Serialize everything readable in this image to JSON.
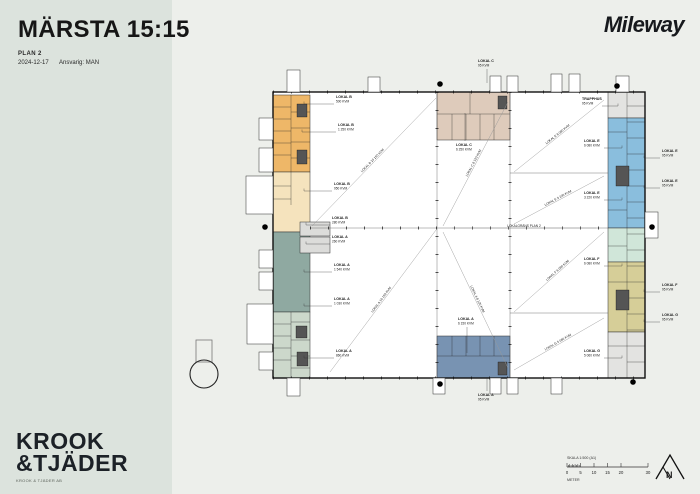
{
  "header": {
    "title": "MÄRSTA 15:15",
    "subtitle": "PLAN 2",
    "date": "2024-12-17",
    "responsible": "Ansvarig: MAN"
  },
  "logos": {
    "client": "Mileway",
    "studio_line1": "KROOK",
    "studio_line2": "&TJÄDER",
    "studio_tagline": "KROOK & TJÄDER AB"
  },
  "scalebar": {
    "title": "SKALA 1:500 (A1)",
    "unit": "METER",
    "ticks": [
      "0",
      "5",
      "10",
      "15",
      "20",
      "30"
    ]
  },
  "north_letter": "N",
  "plan": {
    "colors": {
      "floor": "#ffffff",
      "left_orange": "#eeb768",
      "left_cream": "#f5e3bd",
      "left_teal": "#8fa9a1",
      "left_green": "#ccd8cb",
      "inset_gray": "#dcdcda",
      "right_gray_top": "#e3e3e1",
      "right_blue": "#8abedd",
      "right_mint": "#d0e6d9",
      "right_khaki": "#d6ce98",
      "right_gray_bottom": "#e3e3e1",
      "mid_top_tan": "#decbbb",
      "mid_bottom_blue": "#7893b2"
    },
    "callouts": [
      {
        "x": 336,
        "y": 98,
        "text": "LOKAL B",
        "sub": "500 KVM",
        "lead": 30
      },
      {
        "x": 338,
        "y": 126,
        "text": "LOKAL B",
        "sub": "1 250 KVM",
        "lead": 34
      },
      {
        "x": 334,
        "y": 185,
        "text": "LOKAL B",
        "sub": "950 KVM",
        "lead": 28
      },
      {
        "x": 332,
        "y": 219,
        "text": "LOKAL B",
        "sub": "280 KVM",
        "lead": 24
      },
      {
        "x": 332,
        "y": 238,
        "text": "LOKAL A",
        "sub": "260 KVM",
        "lead": 24
      },
      {
        "x": 334,
        "y": 266,
        "text": "LOKAL A",
        "sub": "1 540 KVM",
        "lead": 28
      },
      {
        "x": 334,
        "y": 300,
        "text": "LOKAL A",
        "sub": "1 030 KVM",
        "lead": 28
      },
      {
        "x": 336,
        "y": 352,
        "text": "LOKAL A",
        "sub": "860 KVM",
        "lead": 30
      },
      {
        "x": 456,
        "y": 146,
        "text": "LOKAL C",
        "sub": "6 250 KVM",
        "vlead": -28
      },
      {
        "x": 478,
        "y": 62,
        "text": "LOKAL C",
        "sub": "95 KVM",
        "vlead": 14
      },
      {
        "x": 458,
        "y": 320,
        "text": "LOKAL A",
        "sub": "6 150 KVM",
        "vlead": 26
      },
      {
        "x": 478,
        "y": 396,
        "text": "LOKAL A",
        "sub": "95 KVM",
        "vlead": -14
      },
      {
        "x": 582,
        "y": 100,
        "text": "TRAPPHUS",
        "sub": "95 KVM",
        "lead": -16
      },
      {
        "x": 584,
        "y": 142,
        "text": "LOKAL E",
        "sub": "6 080 KVM",
        "lead": -18
      },
      {
        "x": 584,
        "y": 194,
        "text": "LOKAL E",
        "sub": "3 220 KVM",
        "lead": -18
      },
      {
        "x": 584,
        "y": 260,
        "text": "LOKAL F",
        "sub": "6 080 KVM",
        "lead": -18
      },
      {
        "x": 584,
        "y": 352,
        "text": "LOKAL G",
        "sub": "5 060 KVM",
        "lead": -18
      },
      {
        "x": 662,
        "y": 152,
        "text": "LOKAL E",
        "sub": "95 KVM",
        "lead": 16
      },
      {
        "x": 662,
        "y": 182,
        "text": "LOKAL E",
        "sub": "95 KVM",
        "lead": 16
      },
      {
        "x": 662,
        "y": 286,
        "text": "LOKAL F",
        "sub": "95 KVM",
        "lead": 16
      },
      {
        "x": 662,
        "y": 316,
        "text": "LOKAL G",
        "sub": "95 KVM",
        "lead": 16
      }
    ],
    "diagonals": [
      {
        "x1": 312,
        "y1": 226,
        "x2": 436,
        "y2": 98,
        "label": "LOKAL B 10 150 KVM"
      },
      {
        "x1": 330,
        "y1": 372,
        "x2": 436,
        "y2": 230,
        "label": "LOKAL A 10 150 KVM"
      },
      {
        "x1": 443,
        "y1": 226,
        "x2": 508,
        "y2": 102,
        "label": "LOKAL C 8 120 KVM"
      },
      {
        "x1": 443,
        "y1": 232,
        "x2": 508,
        "y2": 368,
        "label": "LOKAL A 8 120 KVM"
      },
      {
        "x1": 514,
        "y1": 172,
        "x2": 604,
        "y2": 100,
        "label": "LOKAL E 6 080 KVM"
      },
      {
        "x1": 514,
        "y1": 224,
        "x2": 604,
        "y2": 176,
        "label": "LOKAL E 3 220 KVM"
      },
      {
        "x1": 514,
        "y1": 312,
        "x2": 604,
        "y2": 232,
        "label": "LOKAL F 6 080 KVM"
      },
      {
        "x1": 514,
        "y1": 370,
        "x2": 604,
        "y2": 318,
        "label": "LOKAL G 5 060 KVM"
      },
      {
        "x1": 452,
        "y1": 228,
        "x2": 596,
        "y2": 228,
        "label": "LOKALGRÄNS PLAN 2"
      }
    ]
  }
}
